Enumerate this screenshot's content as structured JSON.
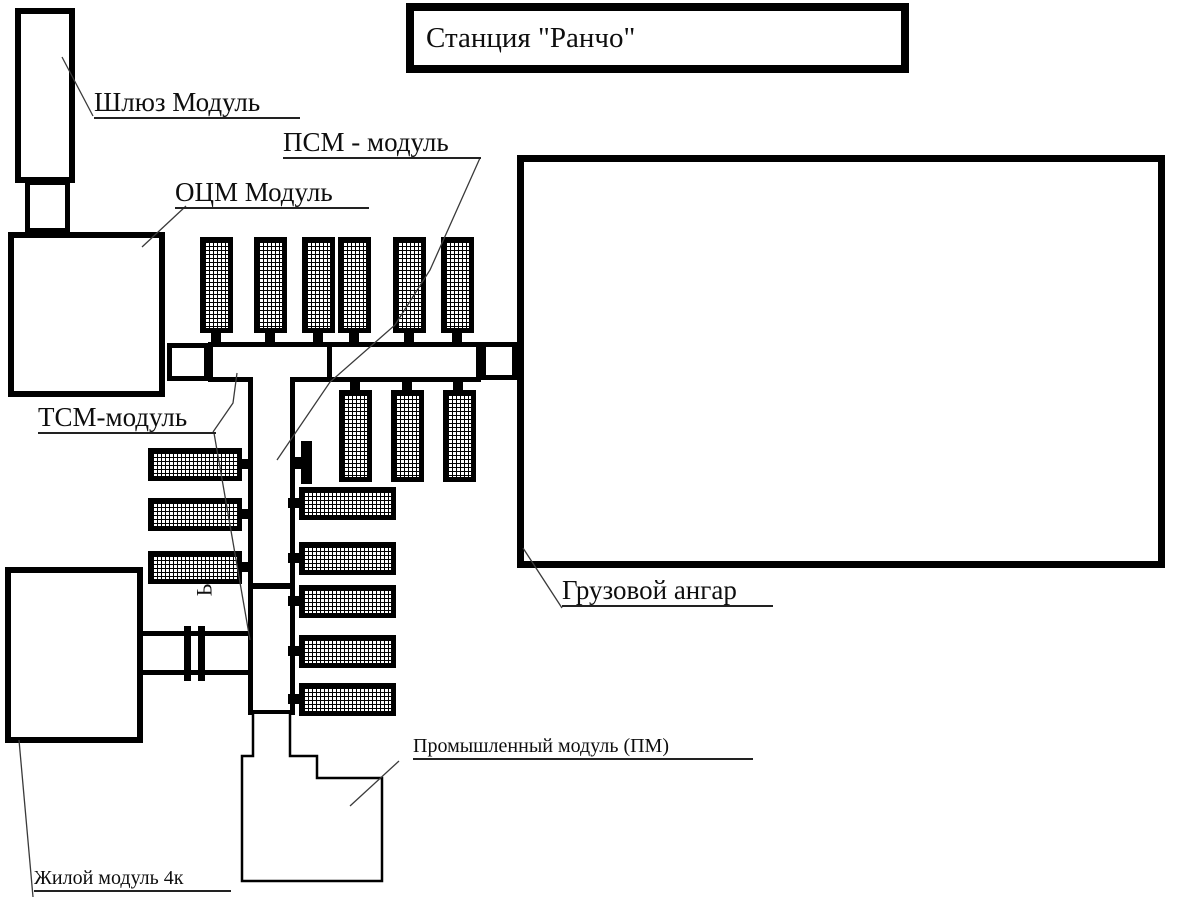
{
  "title": "Станция \"Ранчо\"",
  "labels": {
    "airlock": "Шлюз Модуль",
    "ocm": "ОЦМ Модуль",
    "psm": "ПСМ - модуль",
    "tsm": "ТСМ-модуль",
    "hangar": "Грузовой ангар",
    "industrial": "Промышленный модуль (ПМ)",
    "living": "Жилой модуль 4к",
    "stray_glyph": "Ь"
  },
  "colors": {
    "line": "#000000",
    "background": "#ffffff",
    "leader": "#3a3a3a"
  }
}
